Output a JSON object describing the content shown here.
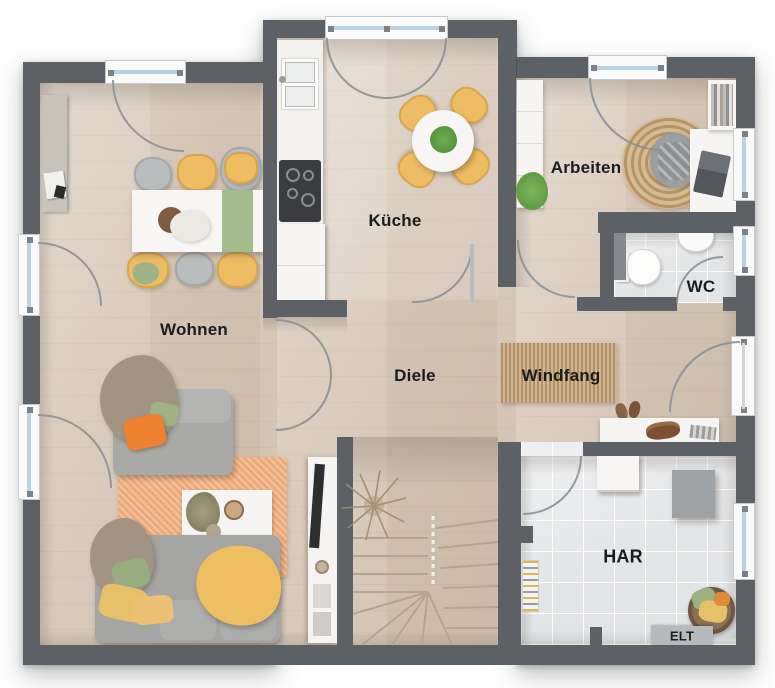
{
  "labels": {
    "kueche": "Küche",
    "arbeiten": "Arbeiten",
    "wc": "WC",
    "wohnen": "Wohnen",
    "diele": "Diele",
    "windfang": "Windfang",
    "har": "HAR",
    "elt": "ELT"
  },
  "rooms": [
    {
      "label": "Küche"
    },
    {
      "label": "Arbeiten"
    },
    {
      "label": "WC"
    },
    {
      "label": "Wohnen"
    },
    {
      "label": "Diele"
    },
    {
      "label": "Windfang"
    },
    {
      "label": "HAR"
    },
    {
      "label": "ELT"
    }
  ],
  "colors": {
    "wall": "#5d6165",
    "wood_floor": "#d8c9b9",
    "kitchen_floor_light": "#e3d6c6",
    "tile_floor": "#e2e4e6",
    "window_glass": "#b9d2e4",
    "accent_yellow": "#eebc62",
    "accent_orange": "#ef8130",
    "accent_green": "#9fb285",
    "rug_orange": "#eeab79",
    "jute": "#c4a57e",
    "label_text": "#1b1c1e"
  },
  "plan_type": "floor-plan-top-view"
}
